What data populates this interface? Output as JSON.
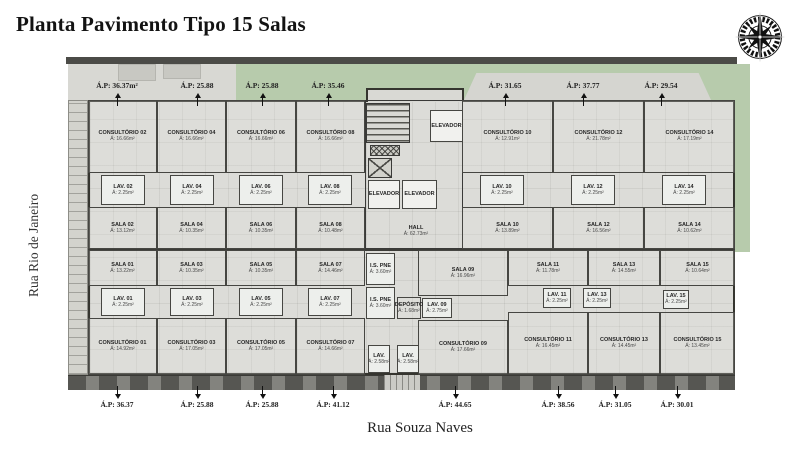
{
  "title": "Planta Pavimento Tipo 15 Salas",
  "streets": {
    "left": "Rua Rio de Janeiro",
    "bottom": "Rua Souza Naves"
  },
  "colors": {
    "wall": "#3a3a38",
    "floor": "#dcdcd8",
    "lawn": "#b7cbac",
    "paving": "#d8d8d3",
    "sidewalk": "#83837e",
    "arrow": "#111111"
  },
  "ap_labels": {
    "top": [
      {
        "text": "Á.P: 36.37m²",
        "x": 117
      },
      {
        "text": "Á.P: 25.88",
        "x": 197
      },
      {
        "text": "Á.P: 25.88",
        "x": 262
      },
      {
        "text": "Á.P: 35.46",
        "x": 328
      },
      {
        "text": "Á.P: 31.65",
        "x": 505
      },
      {
        "text": "Á.P: 37.77",
        "x": 583
      },
      {
        "text": "Á.P: 29.54",
        "x": 661
      }
    ],
    "bottom": [
      {
        "text": "Á.P: 36.37",
        "x": 117
      },
      {
        "text": "Á.P: 25.88",
        "x": 197
      },
      {
        "text": "Á.P: 25.88",
        "x": 262
      },
      {
        "text": "Á.P: 41.12",
        "x": 333
      },
      {
        "text": "Á.P: 44.65",
        "x": 455
      },
      {
        "text": "Á.P: 38.56",
        "x": 558
      },
      {
        "text": "Á.P: 31.05",
        "x": 615
      },
      {
        "text": "Á.P: 30.01",
        "x": 677
      }
    ]
  },
  "plan": {
    "rooms": [
      {
        "id": "consultorio-02",
        "n": "CONSULTÓRIO 02",
        "a": "Á: 16.66m²",
        "k": "c",
        "x": 22,
        "y": 43,
        "w": 69,
        "h": 73
      },
      {
        "id": "consultorio-04",
        "n": "CONSULTÓRIO 04",
        "a": "Á: 16.66m²",
        "k": "c",
        "x": 91,
        "y": 43,
        "w": 69,
        "h": 73
      },
      {
        "id": "consultorio-06",
        "n": "CONSULTÓRIO 06",
        "a": "Á: 16.66m²",
        "k": "c",
        "x": 160,
        "y": 43,
        "w": 70,
        "h": 73
      },
      {
        "id": "consultorio-08",
        "n": "CONSULTÓRIO 08",
        "a": "Á: 16.66m²",
        "k": "c",
        "x": 230,
        "y": 43,
        "w": 69,
        "h": 73
      },
      {
        "id": "lav-02",
        "n": "LAV. 02",
        "a": "Á: 2.25m²",
        "k": "lav",
        "x": 35,
        "y": 118,
        "w": 44,
        "h": 30
      },
      {
        "id": "lav-04",
        "n": "LAV. 04",
        "a": "Á: 2.25m²",
        "k": "lav",
        "x": 104,
        "y": 118,
        "w": 44,
        "h": 30
      },
      {
        "id": "lav-06",
        "n": "LAV. 06",
        "a": "Á: 2.25m²",
        "k": "lav",
        "x": 173,
        "y": 118,
        "w": 44,
        "h": 30
      },
      {
        "id": "lav-08",
        "n": "LAV. 08",
        "a": "Á: 2.25m²",
        "k": "lav",
        "x": 242,
        "y": 118,
        "w": 44,
        "h": 30
      },
      {
        "id": "sala-02",
        "n": "SALA 02",
        "a": "Á: 13.12m²",
        "k": "c",
        "x": 22,
        "y": 150,
        "w": 69,
        "h": 42
      },
      {
        "id": "sala-04",
        "n": "SALA 04",
        "a": "Á: 10.35m²",
        "k": "c",
        "x": 91,
        "y": 150,
        "w": 69,
        "h": 42
      },
      {
        "id": "sala-06",
        "n": "SALA 06",
        "a": "Á: 10.35m²",
        "k": "c",
        "x": 160,
        "y": 150,
        "w": 70,
        "h": 42
      },
      {
        "id": "sala-08",
        "n": "SALA 08",
        "a": "Á: 10.48m²",
        "k": "c",
        "x": 230,
        "y": 150,
        "w": 69,
        "h": 42
      },
      {
        "id": "consultorio-10",
        "n": "CONSULTÓRIO 10",
        "a": "Á: 12.91m²",
        "k": "c",
        "x": 396,
        "y": 43,
        "w": 91,
        "h": 73
      },
      {
        "id": "consultorio-12",
        "n": "CONSULTÓRIO 12",
        "a": "Á: 21.78m²",
        "k": "c",
        "x": 487,
        "y": 43,
        "w": 91,
        "h": 73
      },
      {
        "id": "consultorio-14",
        "n": "CONSULTÓRIO 14",
        "a": "Á: 17.19m²",
        "k": "c",
        "x": 578,
        "y": 43,
        "w": 91,
        "h": 73
      },
      {
        "id": "lav-10",
        "n": "LAV. 10",
        "a": "Á: 2.25m²",
        "k": "lav",
        "x": 414,
        "y": 118,
        "w": 44,
        "h": 30
      },
      {
        "id": "lav-12",
        "n": "LAV. 12",
        "a": "Á: 2.25m²",
        "k": "lav",
        "x": 505,
        "y": 118,
        "w": 44,
        "h": 30
      },
      {
        "id": "lav-14",
        "n": "LAV. 14",
        "a": "Á: 2.25m²",
        "k": "lav",
        "x": 596,
        "y": 118,
        "w": 44,
        "h": 30
      },
      {
        "id": "sala-10",
        "n": "SALA 10",
        "a": "Á: 13.89m²",
        "k": "c",
        "x": 396,
        "y": 150,
        "w": 91,
        "h": 42
      },
      {
        "id": "sala-12",
        "n": "SALA 12",
        "a": "Á: 16.56m²",
        "k": "c",
        "x": 487,
        "y": 150,
        "w": 91,
        "h": 42
      },
      {
        "id": "sala-14",
        "n": "SALA 14",
        "a": "Á: 10.62m²",
        "k": "c",
        "x": 578,
        "y": 150,
        "w": 91,
        "h": 42
      },
      {
        "id": "sala-01",
        "n": "SALA 01",
        "a": "Á: 13.22m²",
        "k": "c",
        "x": 22,
        "y": 193,
        "w": 69,
        "h": 36
      },
      {
        "id": "sala-03",
        "n": "SALA 03",
        "a": "Á: 10.35m²",
        "k": "c",
        "x": 91,
        "y": 193,
        "w": 69,
        "h": 36
      },
      {
        "id": "sala-05",
        "n": "SALA 05",
        "a": "Á: 10.35m²",
        "k": "c",
        "x": 160,
        "y": 193,
        "w": 70,
        "h": 36
      },
      {
        "id": "sala-07",
        "n": "SALA 07",
        "a": "Á: 14.46m²",
        "k": "c",
        "x": 230,
        "y": 193,
        "w": 69,
        "h": 36
      },
      {
        "id": "lav-01",
        "n": "LAV. 01",
        "a": "Á: 2.25m²",
        "k": "lav",
        "x": 35,
        "y": 231,
        "w": 44,
        "h": 28
      },
      {
        "id": "lav-03",
        "n": "LAV. 03",
        "a": "Á: 2.25m²",
        "k": "lav",
        "x": 104,
        "y": 231,
        "w": 44,
        "h": 28
      },
      {
        "id": "lav-05",
        "n": "LAV. 05",
        "a": "Á: 2.25m²",
        "k": "lav",
        "x": 173,
        "y": 231,
        "w": 44,
        "h": 28
      },
      {
        "id": "lav-07",
        "n": "LAV. 07",
        "a": "Á: 2.25m²",
        "k": "lav",
        "x": 242,
        "y": 231,
        "w": 44,
        "h": 28
      },
      {
        "id": "consultorio-01",
        "n": "CONSULTÓRIO 01",
        "a": "Á: 14.92m²",
        "k": "c",
        "x": 22,
        "y": 261,
        "w": 69,
        "h": 57
      },
      {
        "id": "consultorio-03",
        "n": "CONSULTÓRIO 03",
        "a": "Á: 17.05m²",
        "k": "c",
        "x": 91,
        "y": 261,
        "w": 69,
        "h": 57
      },
      {
        "id": "consultorio-05",
        "n": "CONSULTÓRIO 05",
        "a": "Á: 17.05m²",
        "k": "c",
        "x": 160,
        "y": 261,
        "w": 70,
        "h": 57
      },
      {
        "id": "consultorio-07",
        "n": "CONSULTÓRIO 07",
        "a": "Á: 14.66m²",
        "k": "c",
        "x": 230,
        "y": 261,
        "w": 69,
        "h": 57
      },
      {
        "id": "sala-09",
        "n": "SALA 09",
        "a": "Á: 16.96m²",
        "k": "c",
        "x": 352,
        "y": 193,
        "w": 90,
        "h": 46
      },
      {
        "id": "sala-11",
        "n": "SALA 11",
        "a": "Á: 11.78m²",
        "k": "c",
        "x": 442,
        "y": 193,
        "w": 80,
        "h": 36
      },
      {
        "id": "sala-13",
        "n": "SALA 13",
        "a": "Á: 14.55m²",
        "k": "c",
        "x": 522,
        "y": 193,
        "w": 72,
        "h": 36
      },
      {
        "id": "sala-15",
        "n": "SALA 15",
        "a": "Á: 10.64m²",
        "k": "c",
        "x": 594,
        "y": 193,
        "w": 75,
        "h": 36
      },
      {
        "id": "lav-09",
        "n": "LAV. 09",
        "a": "Á: 2.75m²",
        "k": "lav",
        "x": 356,
        "y": 241,
        "w": 30,
        "h": 20
      },
      {
        "id": "lav-11",
        "n": "LAV. 11",
        "a": "Á: 2.25m²",
        "k": "lav",
        "x": 477,
        "y": 231,
        "w": 28,
        "h": 20
      },
      {
        "id": "lav-13",
        "n": "LAV. 13",
        "a": "Á: 2.25m²",
        "k": "lav",
        "x": 517,
        "y": 231,
        "w": 28,
        "h": 20
      },
      {
        "id": "lav-15",
        "n": "LAV. 15",
        "a": "Á: 2.25m²",
        "k": "lav",
        "x": 597,
        "y": 233,
        "w": 26,
        "h": 19
      },
      {
        "id": "consultorio-09",
        "n": "CONSULTÓRIO 09",
        "a": "Á: 17.66m²",
        "k": "c",
        "x": 352,
        "y": 263,
        "w": 90,
        "h": 55
      },
      {
        "id": "consultorio-11",
        "n": "CONSULTÓRIO 11",
        "a": "Á: 16.45m²",
        "k": "c",
        "x": 442,
        "y": 255,
        "w": 80,
        "h": 63
      },
      {
        "id": "consultorio-13",
        "n": "CONSULTÓRIO 13",
        "a": "Á: 14.45m²",
        "k": "c",
        "x": 522,
        "y": 255,
        "w": 72,
        "h": 63
      },
      {
        "id": "consultorio-15",
        "n": "CONSULTÓRIO 15",
        "a": "Á: 13.45m²",
        "k": "c",
        "x": 594,
        "y": 255,
        "w": 75,
        "h": 63
      },
      {
        "id": "stairs",
        "k": "stairs",
        "x": 300,
        "y": 46,
        "w": 44,
        "h": 40
      },
      {
        "id": "elevador-1",
        "n": "ELEVADOR",
        "k": "elev",
        "x": 364,
        "y": 53,
        "w": 33,
        "h": 32
      },
      {
        "id": "shaft-hatch",
        "k": "hh",
        "x": 304,
        "y": 88,
        "w": 30,
        "h": 11
      },
      {
        "id": "shaft-x",
        "k": "hx",
        "x": 302,
        "y": 101,
        "w": 24,
        "h": 20
      },
      {
        "id": "elevador-2",
        "n": "ELEVADOR",
        "k": "elev",
        "x": 302,
        "y": 123,
        "w": 32,
        "h": 29
      },
      {
        "id": "elevador-3",
        "n": "ELEVADOR",
        "k": "elev",
        "x": 336,
        "y": 123,
        "w": 35,
        "h": 29
      },
      {
        "id": "hall",
        "n": "HALL",
        "a": "Á: 62.73m²",
        "k": "lbl",
        "x": 322,
        "y": 165,
        "w": 56,
        "h": 18
      },
      {
        "id": "is-pne-1",
        "n": "I.S. PNE",
        "a": "Á: 3.60m²",
        "k": "lav",
        "x": 300,
        "y": 196,
        "w": 29,
        "h": 32
      },
      {
        "id": "is-pne-2",
        "n": "I.S. PNE",
        "a": "Á: 3.60m²",
        "k": "lav",
        "x": 300,
        "y": 230,
        "w": 29,
        "h": 32
      },
      {
        "id": "deposito",
        "n": "DEPÓSITO",
        "a": "Á: 1.68m²",
        "k": "c",
        "x": 331,
        "y": 240,
        "w": 24,
        "h": 22
      },
      {
        "id": "lav-c1",
        "n": "LAV.",
        "a": "Á: 2.58m²",
        "k": "lav",
        "x": 302,
        "y": 288,
        "w": 22,
        "h": 28
      },
      {
        "id": "lav-c2",
        "n": "LAV.",
        "a": "Á: 2.58m²",
        "k": "lav",
        "x": 331,
        "y": 288,
        "w": 22,
        "h": 28
      }
    ]
  }
}
